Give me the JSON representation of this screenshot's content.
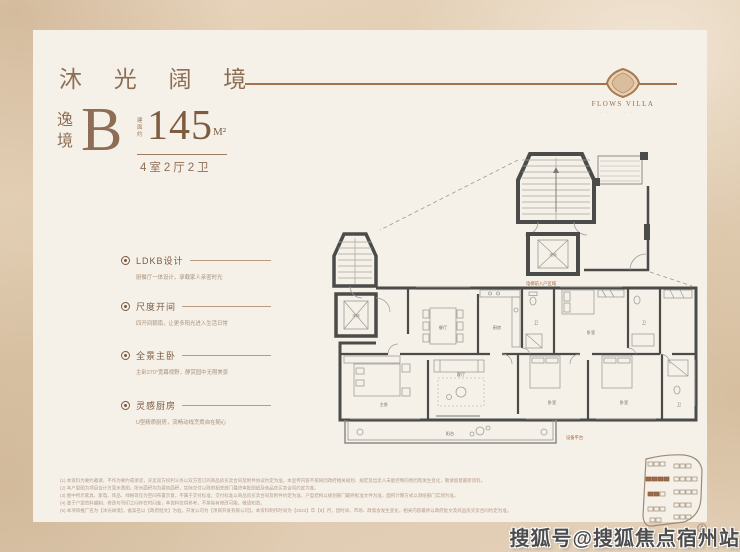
{
  "header": {
    "title": "沐 光 阔 境"
  },
  "logo": {
    "name": "FLOWS VILLA",
    "sub": "∙ ∙ ∙ ∙ ∙ ∙ ∙ ∙"
  },
  "unit": {
    "series": "逸境",
    "type_letter": "B",
    "area_label": "建面约",
    "area": "145",
    "area_unit": "M²",
    "rooms": "4室2厅2卫"
  },
  "features": [
    {
      "title": "LDKB设计",
      "desc": "厨餐厅一体设计，承载家人亲密时光"
    },
    {
      "title": "尺度开间",
      "desc": "四开间朝南，让更多阳光进入生活日常"
    },
    {
      "title": "全景主卧",
      "desc": "主卧270°宽幕视野，静赏园中无限美景"
    },
    {
      "title": "灵感厨房",
      "desc": "U型精质厨房，流畅动线烹煮自在随心"
    }
  ],
  "floorplan": {
    "rooms": {
      "dining": "餐厅",
      "kitchen": "厨房",
      "bath": "卫",
      "bedroom": "卧室",
      "master": "主卧",
      "living": "客厅",
      "balcony": "阳台",
      "elevator": "电梯"
    },
    "labels": {
      "core": "电梯前入户区域",
      "note": "设备平台"
    }
  },
  "disclaimers": [
    "(1) 本资料为要约邀请，不作为要约或承诺，买卖双方权利义务以双方签订的商品房买卖合同及附件协议约定为准。本宣传内容不排除因政府相关规划、规定及出卖人未能控制的原因而发生变化，敬请留意最新资料。",
    "(2) 本户型图为项目设计方案示意图，所示面积均为建筑面积，实际交付以政府相关部门最终审批图纸及商品房买卖合同约定为准。",
    "(3) 图中所示家具、家电、饰品、绿植等仅为空间布置示意，不属于交付标准；交付标准以商品房买卖合同及附件约定为准，户型结构以规划部门最终批准文件为准，面积计算方式以测绘部门实测为准。",
    "(4) 鉴于户型资料编制、修改与刊印之间存在时间差，本资料仅供参考，不排除有修改可能，敬请知悉。",
    "(5) 本项目推广名为【沐光阔境】，备案名以【政府批文】为准，开发公司为【项目开发有限公司】。本资料制作时间为【2022】年【9】月，因时间、市场、政策会发生变化，相关内容最终以政府批文及商品房买卖合同约定为准。"
  ],
  "watermark": {
    "text": "搜狐号@搜狐焦点宿州站"
  },
  "colors": {
    "accent_brown": "#8d6e55",
    "line_brown": "#a2734f",
    "wall": "#4b4b49",
    "background": "#dcc6a9",
    "card": "#f6f1e8",
    "highlight_block": "#9c6b4a",
    "annotation": "#a4623d"
  }
}
